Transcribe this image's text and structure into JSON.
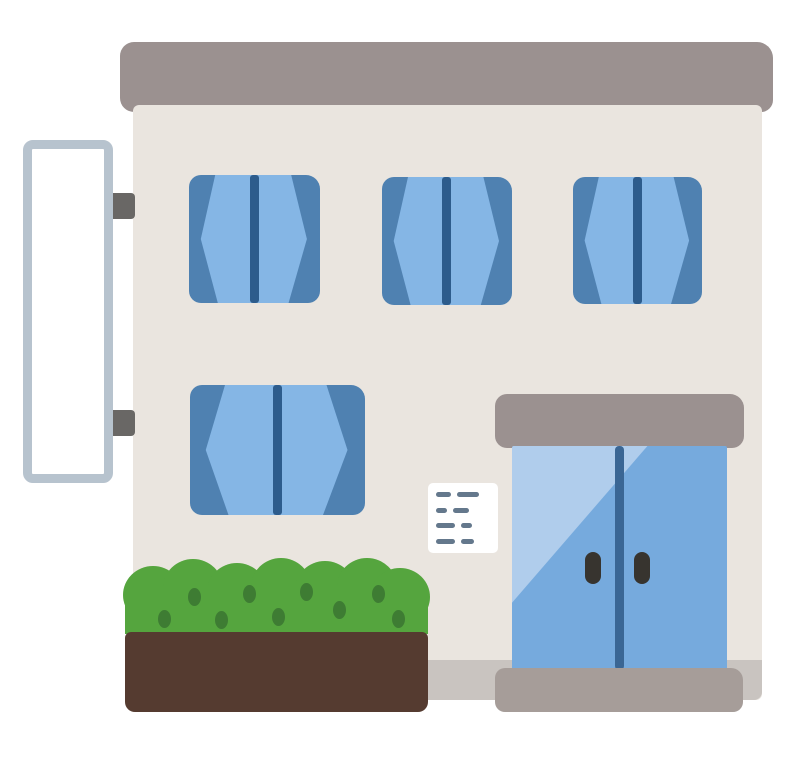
{
  "scene": {
    "description": "Flat cartoon clip-art of a two-story building: gray flat roof, beige facade, three upper windows and one lower window with blue open curtains, a blank white vertical signboard mounted on the left wall with two brackets, a glass double-door entrance with gray awning and step, a small white notice sheet on the wall, and a green hedge in a dark brown planter box.",
    "background_color": "#ffffff"
  },
  "palette": {
    "roof_gray": "#9b9190",
    "awning_gray": "#9b9190",
    "wall_beige": "#eae5df",
    "foundation_gray": "#c9c4c0",
    "step_gray": "#a69d99",
    "curtain_dark_blue": "#4f81b1",
    "curtain_light_blue": "#85b6e5",
    "window_bar_navy": "#2d5c8c",
    "door_glass_blue": "#76aadd",
    "door_reflection_blue": "#b0cdec",
    "door_divider_navy": "#3a6694",
    "door_handle_dark": "#37342f",
    "sign_border_blue_gray": "#b7c3ce",
    "sign_face_white": "#ffffff",
    "bracket_gray": "#696765",
    "plaque_white": "#ffffff",
    "plaque_text_gray": "#64788c",
    "hedge_green": "#55a53e",
    "hedge_spot_green": "#3e7c33",
    "planter_brown": "#553b30"
  },
  "counts": {
    "upper_windows": 3,
    "lower_windows": 1,
    "door_panels": 2,
    "door_handles": 2,
    "sign_brackets": 2,
    "plaque_text_lines": 4,
    "hedge_spots": 9
  }
}
